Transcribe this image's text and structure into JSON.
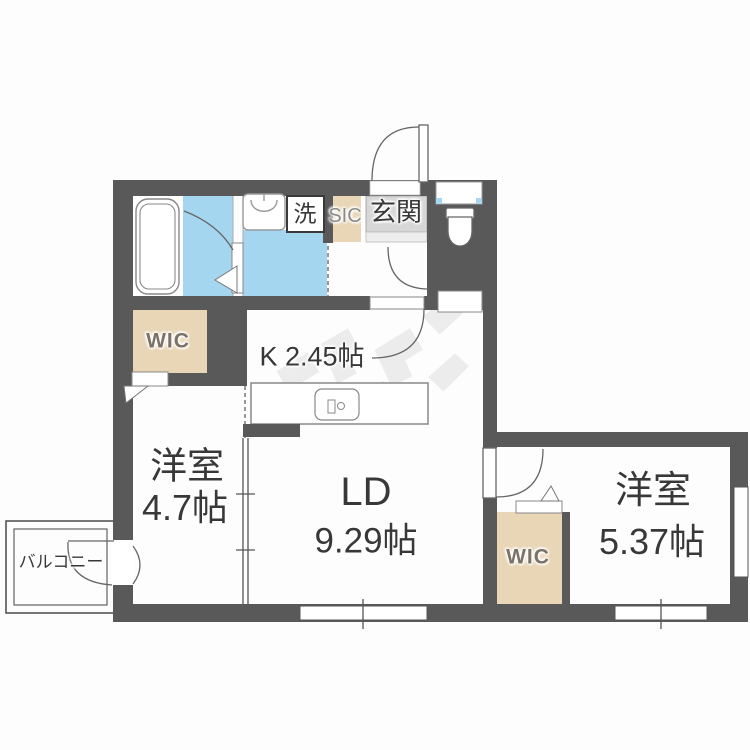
{
  "floorplan": {
    "rooms": {
      "living_dining": {
        "name": "LD",
        "size": "9.29帖"
      },
      "western_room_1": {
        "name": "洋室",
        "size": "4.7帖"
      },
      "western_room_2": {
        "name": "洋室",
        "size": "5.37帖"
      },
      "kitchen": {
        "label": "K 2.45帖"
      },
      "entrance": {
        "label": "玄関"
      },
      "shoe_closet": {
        "label": "SIC"
      },
      "walk_in_closet_left": {
        "label": "WIC"
      },
      "walk_in_closet_right": {
        "label": "WIC"
      },
      "laundry": {
        "label": "洗"
      },
      "balcony": {
        "label": "バルコニー"
      }
    },
    "colors": {
      "wall": "#595959",
      "wet_area_blue": "#a5d6f0",
      "closet_beige": "#e9d6b6",
      "entrance_tile": "#d7d7d7",
      "fixture_line": "#888888",
      "label_dark": "#383838",
      "label_gray": "#8a8a8a"
    },
    "fixtures": {
      "bathtub": "bathtub-icon",
      "wash_basin": "wash-basin-icon",
      "toilet": "toilet-icon",
      "kitchen_sink": "kitchen-sink-icon",
      "washing_machine_slot": "washing-machine-box"
    }
  }
}
